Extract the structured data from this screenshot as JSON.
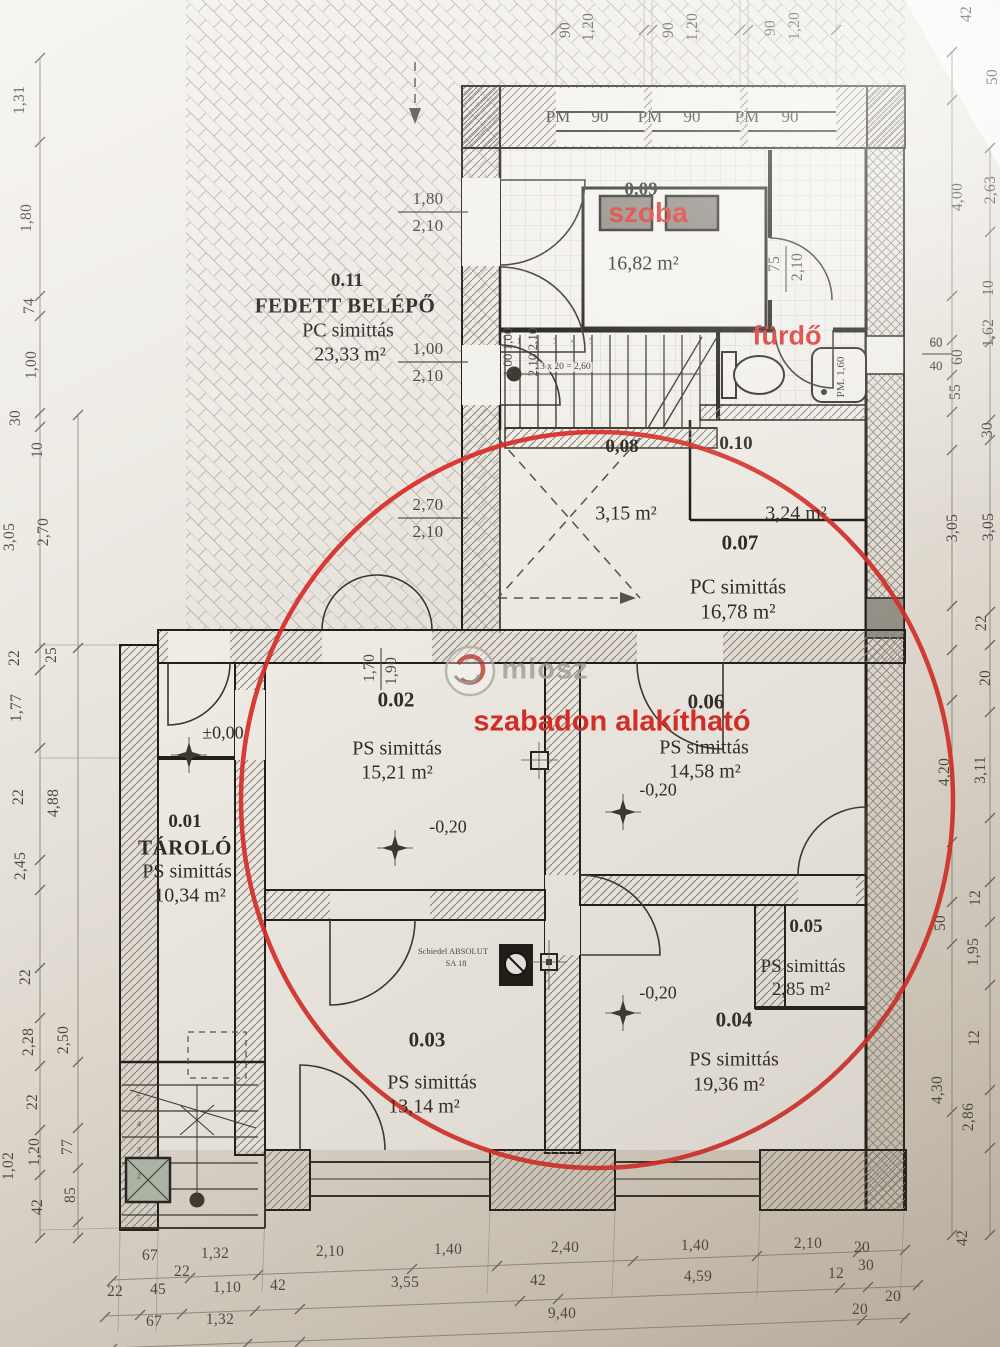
{
  "annotations": {
    "szoba": "szoba",
    "furdo": "fürdő",
    "note": "szabadon alakítható"
  },
  "watermark": {
    "text": "miosz"
  },
  "rooms": {
    "r11": {
      "num": "0.11",
      "name": "FEDETT BELÉPŐ",
      "finish": "PC simittás",
      "area": "23,33 m²"
    },
    "r09": {
      "num": "0.09",
      "area": "16,82 m²"
    },
    "r10": {
      "num": "0.10",
      "area": "3,24 m²"
    },
    "r08": {
      "num": "0,08",
      "area": "3,15 m²"
    },
    "r07": {
      "num": "0.07",
      "finish": "PC simittás",
      "area": "16,78 m²"
    },
    "r06": {
      "num": "0.06",
      "finish": "PS simittás",
      "area": "14,58 m²"
    },
    "r05": {
      "num": "0.05",
      "finish": "PS simittás",
      "area": "2,85 m²"
    },
    "r04": {
      "num": "0.04",
      "finish": "PS simittás",
      "area": "19,36 m²"
    },
    "r03": {
      "num": "0.03",
      "finish": "PS simittás",
      "area": "13,14 m²"
    },
    "r02": {
      "num": "0.02",
      "finish": "PS simittás",
      "area": "15,21 m²"
    },
    "r01": {
      "num": "0.01",
      "name": "TÁROLÓ",
      "finish": "PS simittás",
      "area": "10,34 m²"
    }
  },
  "levels": {
    "zero": "±0,00",
    "minus": "-0,20"
  },
  "fixtures": {
    "chimney1": "Schiedel ABSOLUT",
    "chimney2": "SA 18",
    "washing": "PM. 1,60",
    "stair_formula": "13 x 20 = 2,60"
  },
  "openings": {
    "d1w": "1,80",
    "d1h": "2,10",
    "d2w": "1,00",
    "d2h": "2,10",
    "d3w": "2,70",
    "d3h": "2,10",
    "d4w": "1,70",
    "d4h": "1,90",
    "d5w": "75",
    "d5h": "2,10",
    "d6w": "60",
    "d6h": "40",
    "d7w": "1,00  1,00",
    "d7h": "2,10  2,10"
  },
  "stairs": {
    "upper": [
      "1",
      "2",
      "3",
      "4",
      "5"
    ],
    "lower": [
      "5",
      "4",
      "3",
      "2"
    ]
  },
  "dims": {
    "top": [
      "90",
      "1,20",
      "90",
      "1,20",
      "90",
      "1,20"
    ],
    "top_corner": "42",
    "pm": [
      "PM",
      "90",
      "PM",
      "90",
      "PM",
      "90"
    ],
    "left": [
      "1,31",
      "1,80",
      "74",
      "1,00",
      "30",
      "10",
      "3,05",
      "2,70",
      "22",
      "25",
      "1,77",
      "22",
      "4,88",
      "2,45",
      "22",
      "2,28",
      "2,50",
      "22",
      "1,20",
      "77",
      "42",
      "85",
      "1,02"
    ],
    "right": [
      "50",
      "4,00",
      "2,63",
      "10",
      "1,62",
      "60",
      "40",
      "60",
      "55",
      "30",
      "3,05",
      "3,05",
      "22",
      "20",
      "4,20",
      "3,11",
      "12",
      "50",
      "1,95",
      "12",
      "4,30",
      "2,86"
    ],
    "b1": [
      "67",
      "1,32",
      "2,10",
      "1,40",
      "2,40",
      "1,40",
      "2,10",
      "20",
      "30"
    ],
    "b1x": "22",
    "b2": [
      "22",
      "45",
      "1,10",
      "42",
      "3,55",
      "42",
      "4,59",
      "12",
      "20"
    ],
    "b3": [
      "67",
      "1,32",
      "9,40",
      "20"
    ],
    "b_corner": "42"
  }
}
